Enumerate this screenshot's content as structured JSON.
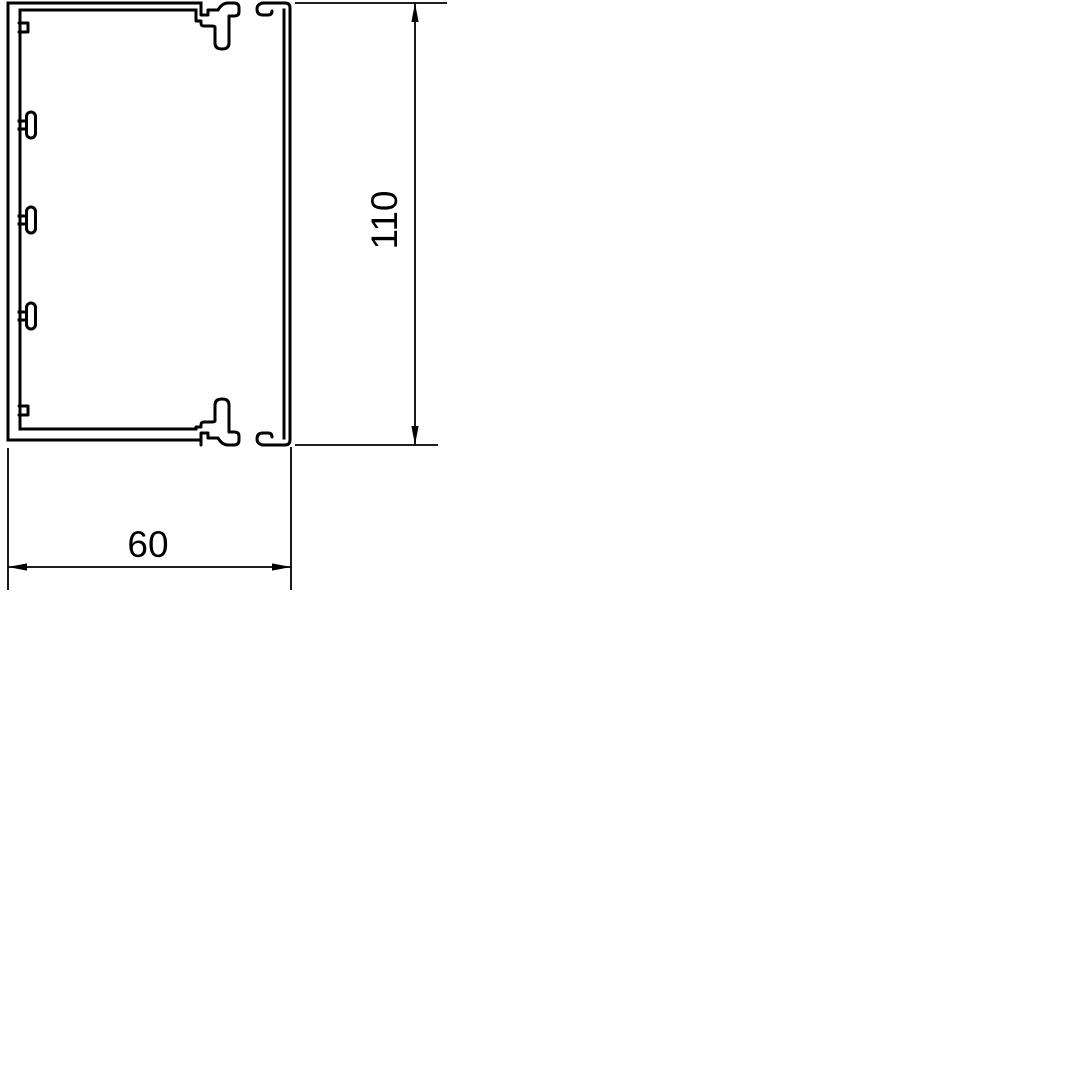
{
  "page": {
    "background_color": "#ffffff",
    "line_color": "#000000"
  },
  "drawing": {
    "kind": "cable-trunking-cross-section",
    "parts": {
      "base": "trunking-base-profile",
      "cover": "trunking-cover-profile"
    },
    "dimensions": {
      "width": {
        "label": "60"
      },
      "height": {
        "label": "110"
      }
    }
  }
}
